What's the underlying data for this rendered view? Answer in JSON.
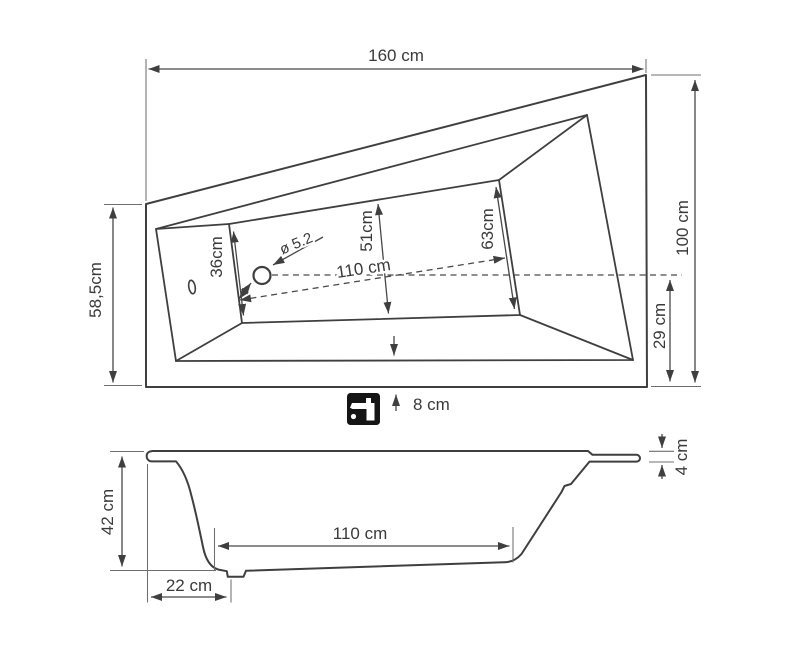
{
  "drawing": {
    "subject": "asymmetric bathtub technical drawing",
    "views": [
      "top view",
      "side view"
    ]
  },
  "top_view": {
    "labels": {
      "overall_length": "160 cm",
      "overall_width": "100 cm",
      "left_edge_width": "58,5cm",
      "basin_width_head": "36cm",
      "basin_width_middle": "51cm",
      "basin_width_foot": "63cm",
      "drain_diameter": "ø 5.2",
      "basin_diagonal_length": "110 cm",
      "drain_axis_to_edge": "29 cm",
      "faucet_edge_offset": "8 cm"
    }
  },
  "side_view": {
    "labels": {
      "tub_height": "42 cm",
      "bottom_length": "110 cm",
      "drain_from_edge": "22 cm",
      "rim_height": "4 cm"
    }
  },
  "icons": {
    "faucet": "faucet-icon"
  },
  "colors": {
    "outline": "#3f3f3f",
    "dimension_line": "#474747",
    "extension_line": "#6f6f6f",
    "text": "#3a3a3a",
    "icon_background": "#151515",
    "background": "#ffffff"
  }
}
